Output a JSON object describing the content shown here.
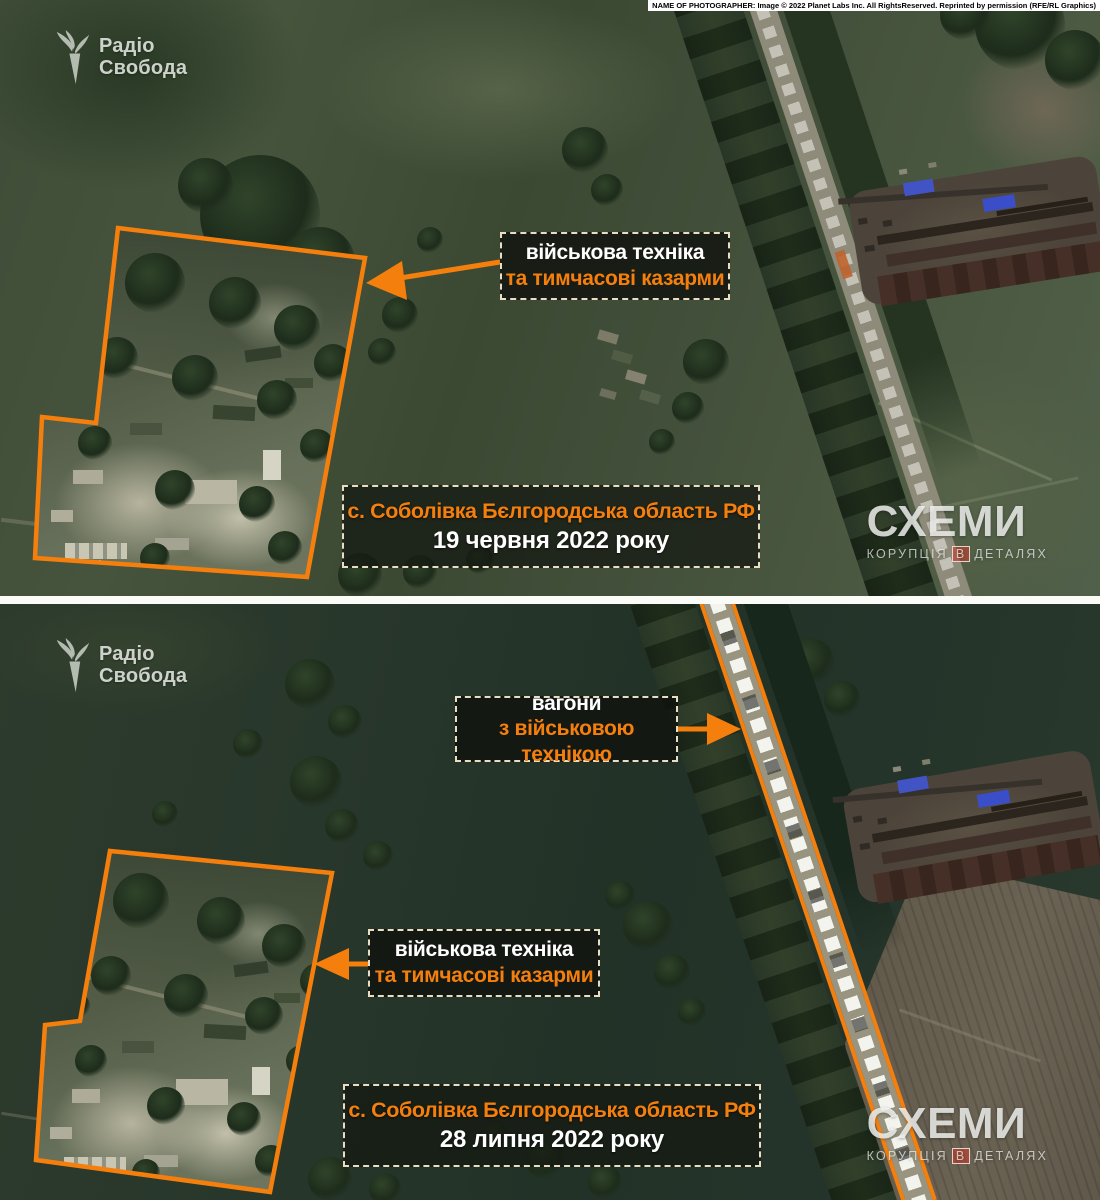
{
  "credit": "NAME OF PHOTOGRAPHER: Image © 2022 Planet Labs Inc. All RightsReserved. Reprinted by permission (RFE/RL Graphics)",
  "branding": {
    "radio_svoboda": {
      "line1": "Радіо",
      "line2": "Свобода"
    },
    "schemes": {
      "title": "СХЕМИ",
      "tagline_part1": "КОРУПЦІЯ",
      "tagline_part2": "В",
      "tagline_part3": "ДЕТАЛЯХ"
    }
  },
  "colors": {
    "accent_orange": "#F57F0D",
    "dashed_border": "#E9DDC4",
    "roof_blue": "#4254C5"
  },
  "panels": [
    {
      "id": "june",
      "callouts": [
        {
          "line1": "військова техніка",
          "line2": "та тимчасові казарми"
        }
      ],
      "caption": {
        "location": "с. Соболівка Бєлгородська область РФ",
        "date": "19 червня 2022 року"
      }
    },
    {
      "id": "july",
      "callouts": [
        {
          "line1": "вагони",
          "line2": "з військовою технікою"
        },
        {
          "line1": "військова техніка",
          "line2": "та тимчасові казарми"
        }
      ],
      "caption": {
        "location": "с. Соболівка Бєлгородська область РФ",
        "date": "28 липня 2022 року"
      }
    }
  ]
}
